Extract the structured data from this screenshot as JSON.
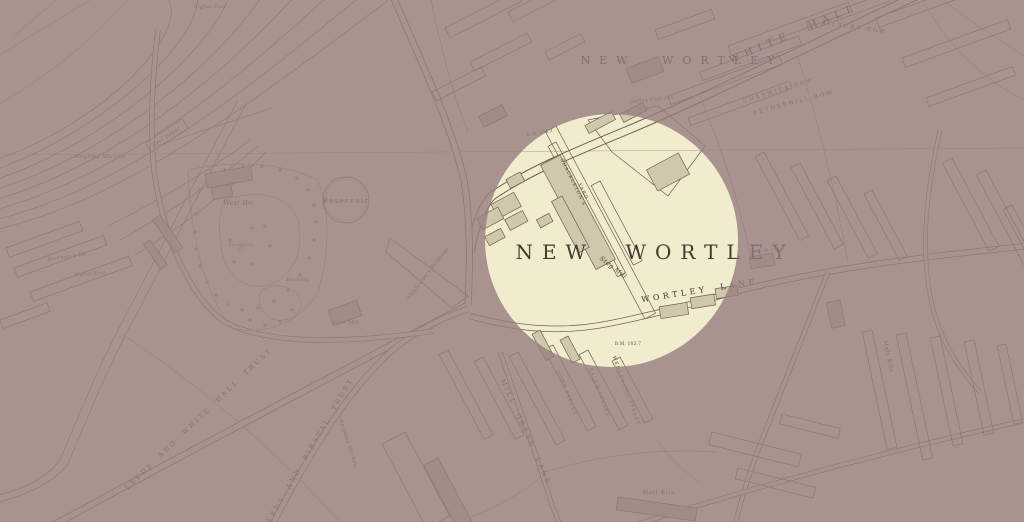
{
  "map": {
    "kind": "historical town plan with circular spotlight highlight",
    "colors": {
      "paper": "#f2ecce",
      "ink": "#6b6152",
      "building_fill": "#cfc8ac",
      "spotlight_tint_overlay": "#967d80",
      "outside_background": "#a89390"
    },
    "spotlight": {
      "shape": "circle"
    },
    "labels": {
      "district_large": "NEW WORTLEY",
      "district_top": "NEW WORTLEY",
      "white_hall_road": "WHITE HALL",
      "kilburn_row": "KILBURN ROW",
      "chadwick_row": "CHADWICK ROW",
      "fetherhill_row": "FETHERHILL ROW",
      "darley_carr_inn": "Darley Carr Inn",
      "wortley_lane": "WORTLEY LANE",
      "shackletons_yard_line1": "SHACKLETON'S",
      "shackletons_yard_line2": "YARD",
      "stag_mill": "Stag Mill",
      "corn_mill": "Corn Mill",
      "leeds_white_hall_trust": "LEEDS AND WHITE HALL TRUST",
      "leeds_birstal_trust": "LEEDS AND BIRSTAL TRUST",
      "mill_green_lane": "MILL GREEN LANE",
      "john_street": "JOHN STREET",
      "salem_street": "SALEM STREET",
      "wedgewood_street": "WEDGEWOOD STREET",
      "coal_depot": "Coal Depot",
      "weighing_machine": "Weighing Machine",
      "weighing_machine_2": "Weighing Machine",
      "signal_post_top": "Signal Post",
      "signal_post_left": "Signal Post",
      "boatmans_house": "Boatman's Ho.",
      "west_house": "West Ho.",
      "reservoir": "Reservoir",
      "fountain": "Fountain",
      "rockery": "Rockery",
      "malt_kiln_south": "Malt Kiln",
      "malt_kiln_east": "Malt Kiln",
      "shackletons_buildings": "Shackleton's Buildings",
      "bm_1": "B.M. 104.3",
      "bm_2": "B.M. 103.7",
      "bm_3": "B.M. 101.9"
    }
  }
}
